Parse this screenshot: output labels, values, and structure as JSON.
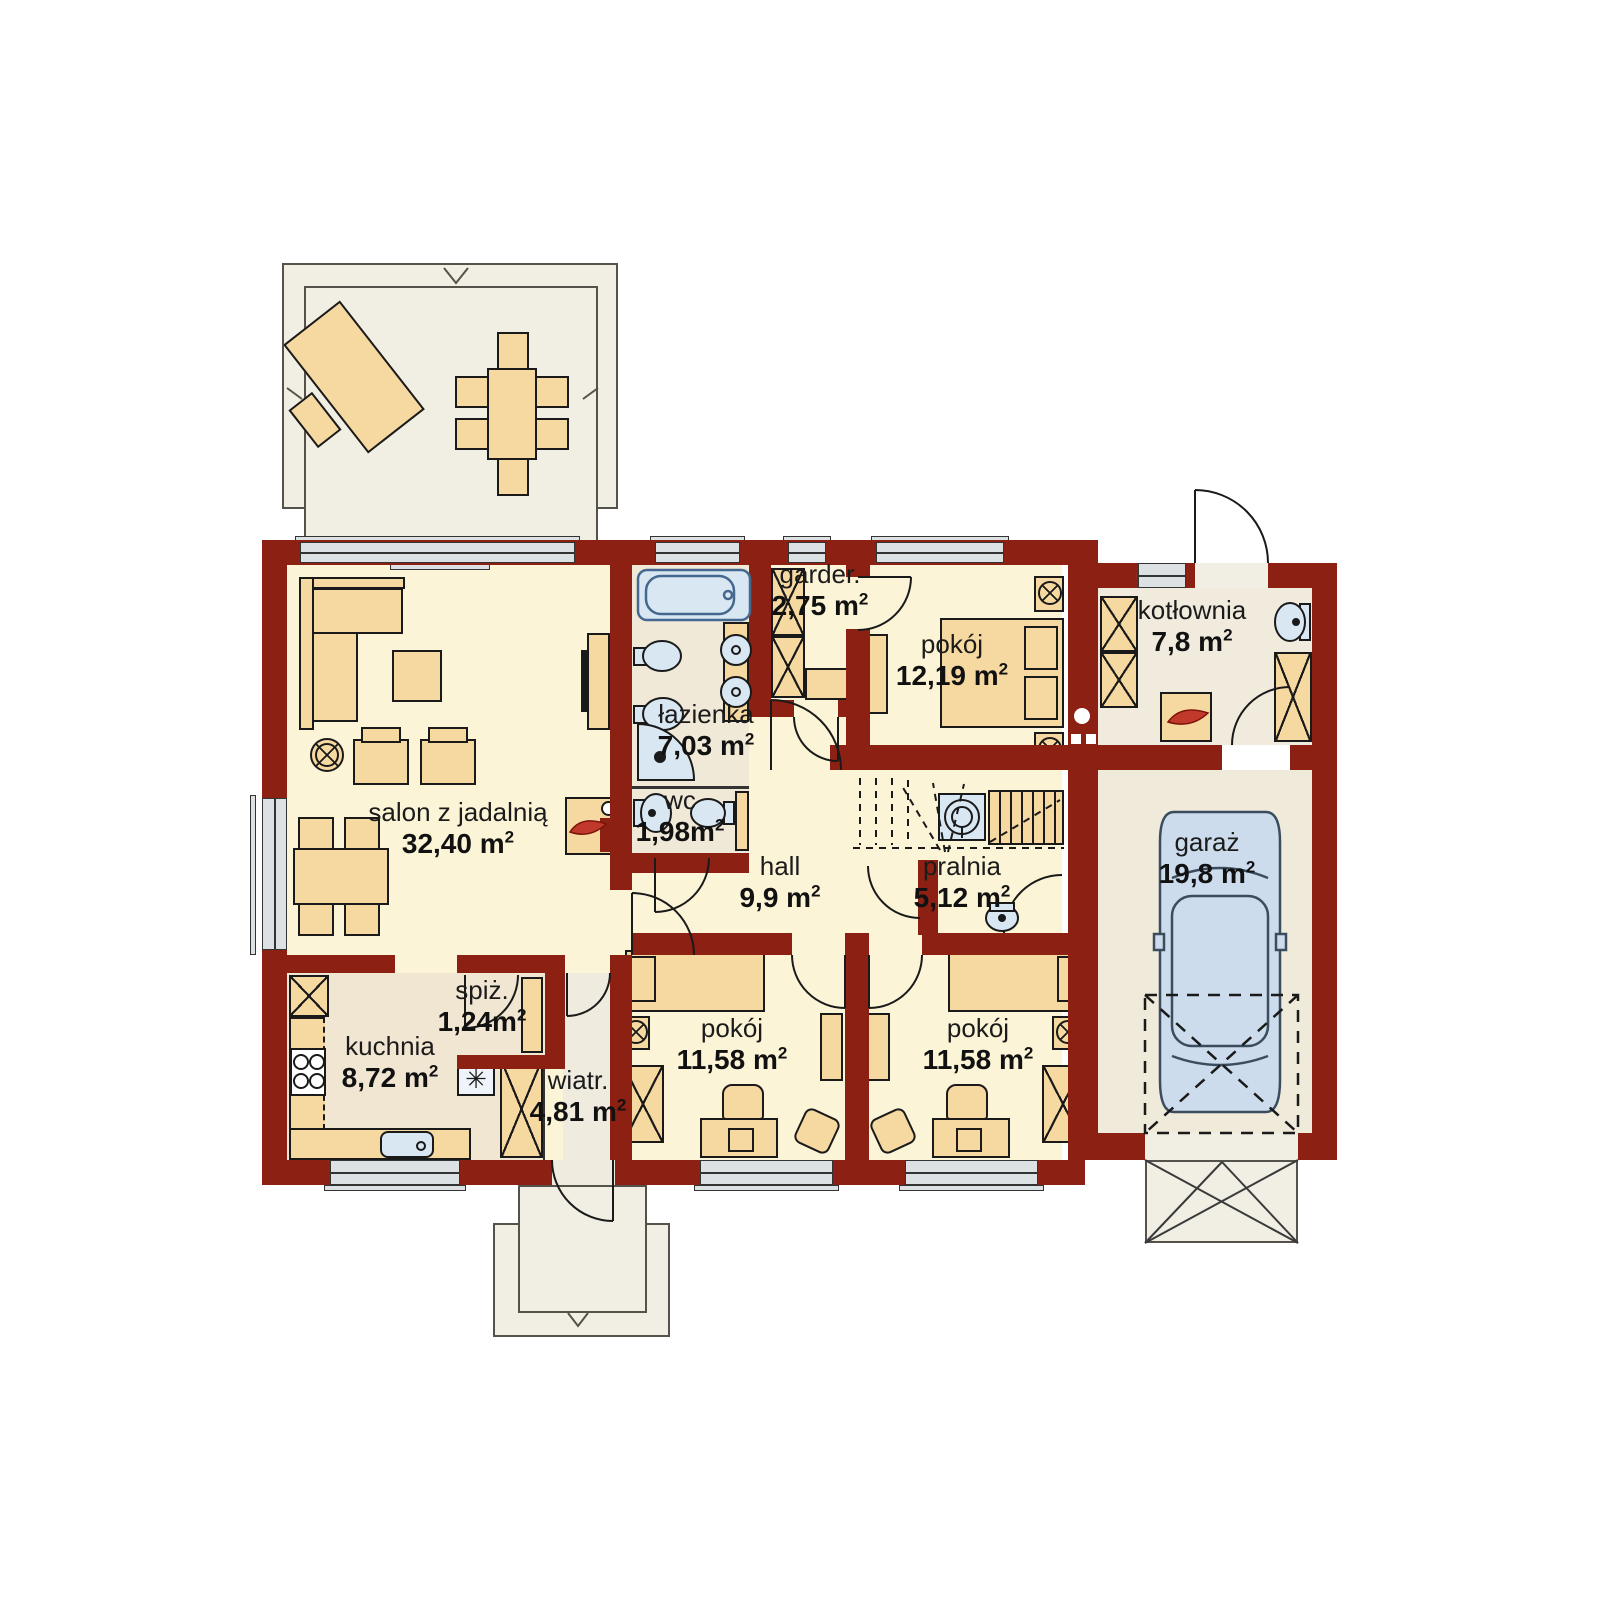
{
  "plan_type": "floor-plan",
  "colors": {
    "wall": "#8b2013",
    "floor_main": "#fbf4d6",
    "floor_service": "#f0e9d8",
    "furniture": "#f6d8a1",
    "fixture_blue": "#d9e7f3",
    "window_gray": "#dce1e4",
    "outdoor": "#f1eee3",
    "flame_red": "#c0392b"
  },
  "symbols": {
    "fridge_snowflake": "✳"
  },
  "rooms": [
    {
      "id": "salon",
      "name": "salon z jadalnią",
      "area": "32,40 m",
      "sup": "2"
    },
    {
      "id": "lazienka",
      "name": "łazienka",
      "area": "7,03 m",
      "sup": "2"
    },
    {
      "id": "wc",
      "name": "wc",
      "area": "1,98m",
      "sup": "2"
    },
    {
      "id": "garderoba",
      "name": "garder.",
      "area": "2,75 m",
      "sup": "2"
    },
    {
      "id": "pokoj-sypialnia",
      "name": "pokój",
      "area": "12,19 m",
      "sup": "2"
    },
    {
      "id": "kotlownia",
      "name": "kotłownia",
      "area": "7,8 m",
      "sup": "2"
    },
    {
      "id": "garaz",
      "name": "garaż",
      "area": "19,8 m",
      "sup": "2"
    },
    {
      "id": "hall",
      "name": "hall",
      "area": "9,9 m",
      "sup": "2"
    },
    {
      "id": "pralnia",
      "name": "pralnia",
      "area": "5,12 m",
      "sup": "2"
    },
    {
      "id": "spizarnia",
      "name": "spiż.",
      "area": "1,24m",
      "sup": "2"
    },
    {
      "id": "kuchnia",
      "name": "kuchnia",
      "area": "8,72 m",
      "sup": "2"
    },
    {
      "id": "wiatrolap",
      "name": "wiatr.",
      "area": "4,81 m",
      "sup": "2"
    },
    {
      "id": "pokoj-1",
      "name": "pokój",
      "area": "11,58 m",
      "sup": "2"
    },
    {
      "id": "pokoj-2",
      "name": "pokój",
      "area": "11,58 m",
      "sup": "2"
    }
  ]
}
